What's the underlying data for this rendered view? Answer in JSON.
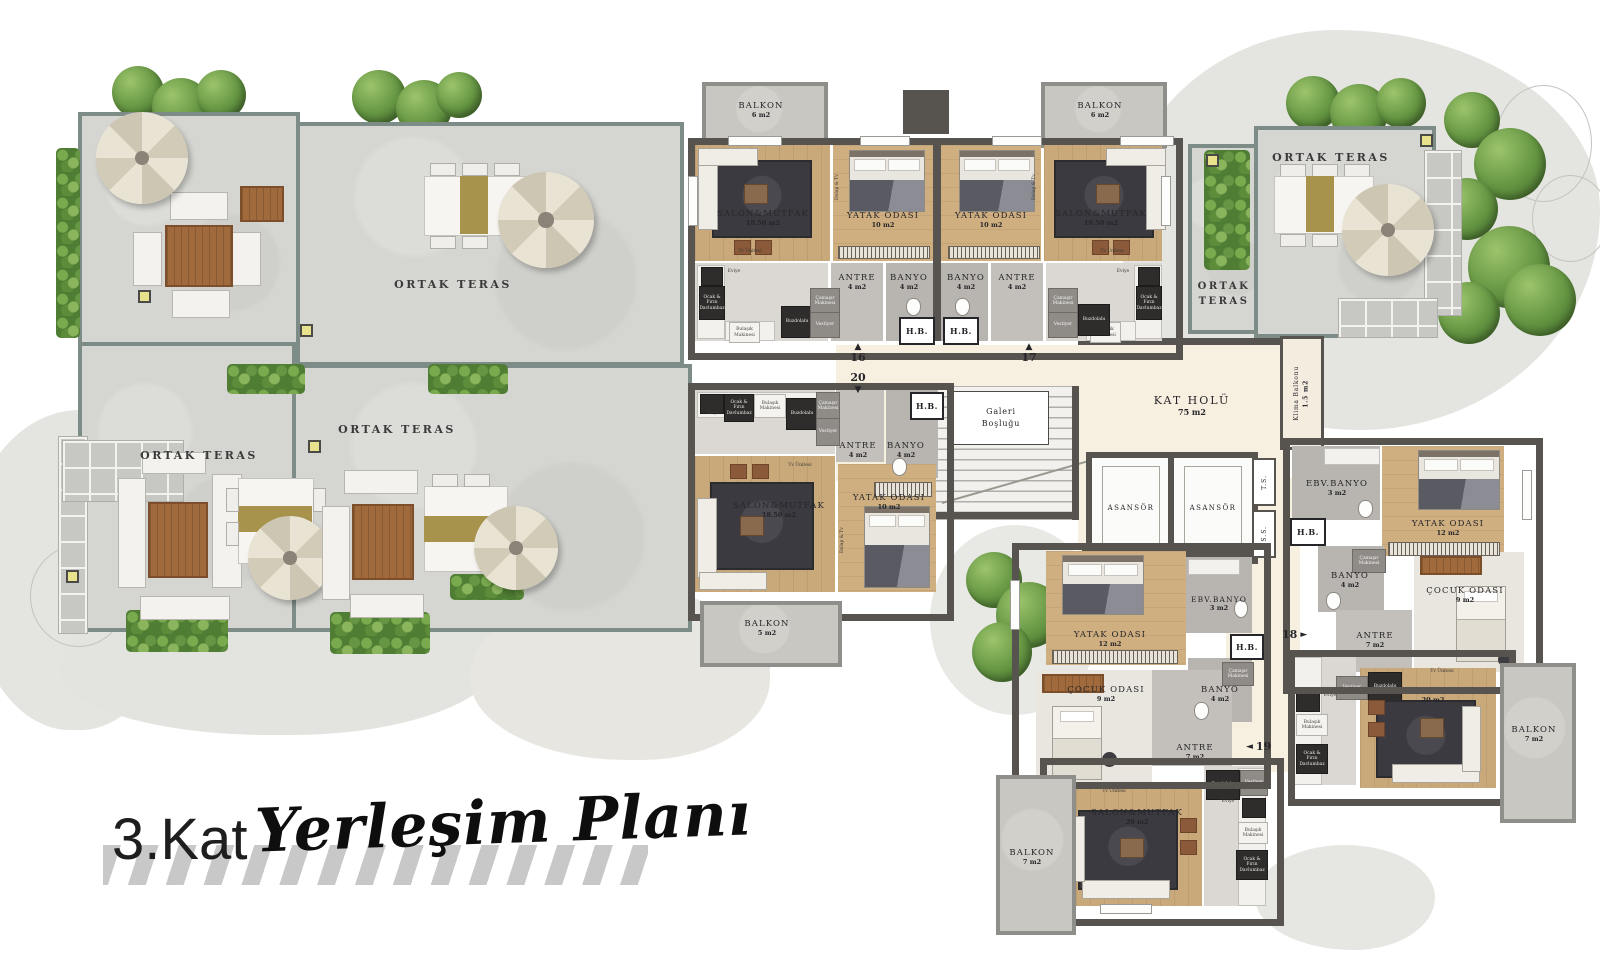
{
  "title": {
    "floor_label": "3.Kat",
    "plan_label": "Yerleşim Planı"
  },
  "common": {
    "terrace_label": "ORTAK TERAS",
    "hall_name": "KAT HOLÜ",
    "hall_area": "75 m2",
    "elevator_label": "ASANSÖR",
    "gallery_line1": "Galeri",
    "gallery_line2": "Boşluğu",
    "klima_name": "Klima Balkonu",
    "klima_area": "1.5 m2",
    "shaft_top": "T.S.",
    "shaft_bottom": "S.S.",
    "hb_label": "H.B."
  },
  "room_names": {
    "balkon": "BALKON",
    "salon": "SALON&MUTFAK",
    "yatak": "YATAK ODASI",
    "antre": "ANTRE",
    "banyo": "BANYO",
    "ebv_banyo": "EBV.BANYO",
    "cocuk": "ÇOCUK ODASI"
  },
  "areas": {
    "balkon6": "6 m2",
    "balkon5": "5 m2",
    "balkon7": "7 m2",
    "salon1850": "18.50 m2",
    "salon20": "20 m2",
    "yatak10": "10 m2",
    "yatak12": "12 m2",
    "antre4": "4 m2",
    "antre7": "7 m2",
    "banyo4": "4 m2",
    "ebv3": "3 m2",
    "cocuk9": "9 m2"
  },
  "units": {
    "u16": {
      "number": "16",
      "arrow": "▲"
    },
    "u17": {
      "number": "17",
      "arrow": "▲"
    },
    "u18": {
      "number": "18",
      "arrow": "►"
    },
    "u19": {
      "number": "19",
      "arrow": "◄"
    },
    "u20": {
      "number": "20",
      "arrow": "▼"
    }
  },
  "fixtures": {
    "ocak": "Ocak & Fırın Davlumbaz",
    "eviye": "Eviye",
    "bulasik": "Bulaşık Makinesi",
    "buzdolabi": "Buzdolabı",
    "camasir": "Çamaşır Makinesi",
    "vestiyer": "Vestiyer",
    "tv_unit": "Tv Ünitesi",
    "dolap_tv": "Dolap & Tv"
  },
  "colors": {
    "unit_wall": "#57534e",
    "terrace_wall": "#7e8c87",
    "terrace_floor": "#d5d6d1",
    "wood_floor": "#cbaa7c",
    "hall_floor": "#f7efdf",
    "bath_floor": "#b8b4af",
    "balcony_floor": "#c9c7c2",
    "greenery": "#5d8f3e",
    "rug": "#3b3a40"
  }
}
